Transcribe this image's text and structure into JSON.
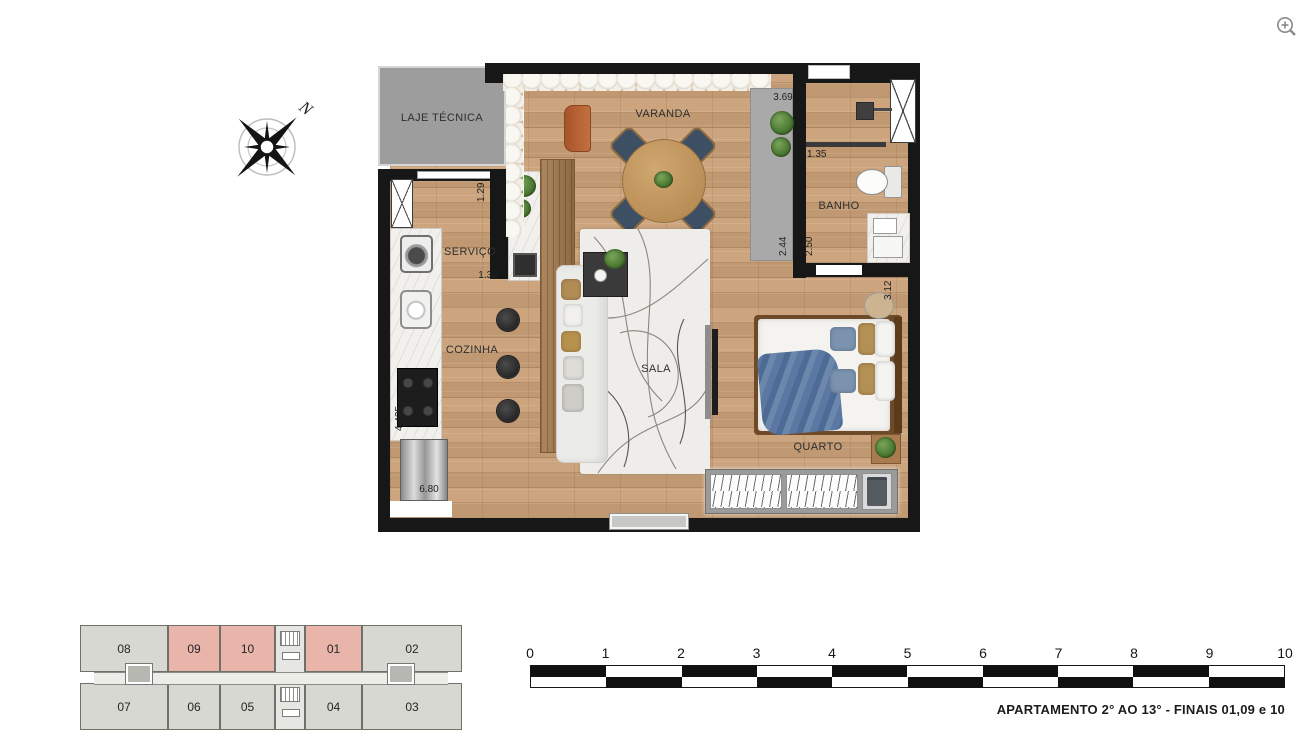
{
  "icons": {
    "zoom": "zoom-in",
    "compass": "compass-rose"
  },
  "compass": {
    "north": "N"
  },
  "plan": {
    "rooms": {
      "laje": "LAJE TÉCNICA",
      "varanda": "VARANDA",
      "banho": "BANHO",
      "servico": "SERVIÇO",
      "cozinha": "COZINHA",
      "sala": "SALA",
      "quarto": "QUARTO"
    },
    "dims": {
      "d369": "3.69",
      "d135": "1.35",
      "d129": "1.29",
      "d138": "1.38",
      "d244": "2.44",
      "d250": "2.50",
      "d312": "3.12",
      "d4405": "4.405",
      "d680": "6.80"
    }
  },
  "key_plan": {
    "top_row": [
      {
        "label": "08",
        "highlighted": false
      },
      {
        "label": "09",
        "highlighted": true
      },
      {
        "label": "10",
        "highlighted": true
      },
      {
        "label": "01",
        "highlighted": true
      },
      {
        "label": "02",
        "highlighted": false
      }
    ],
    "bottom_row": [
      {
        "label": "07",
        "highlighted": false
      },
      {
        "label": "06",
        "highlighted": false
      },
      {
        "label": "05",
        "highlighted": false
      },
      {
        "label": "04",
        "highlighted": false
      },
      {
        "label": "03",
        "highlighted": false
      }
    ],
    "colors": {
      "highlight": "#e9b5ab",
      "normal": "#d6d8d1"
    }
  },
  "scale_bar": {
    "ticks": [
      "0",
      "1",
      "2",
      "3",
      "4",
      "5",
      "6",
      "7",
      "8",
      "9",
      "10"
    ]
  },
  "caption": "APARTAMENTO 2° AO 13° - FINAIS 01,09 e 10"
}
